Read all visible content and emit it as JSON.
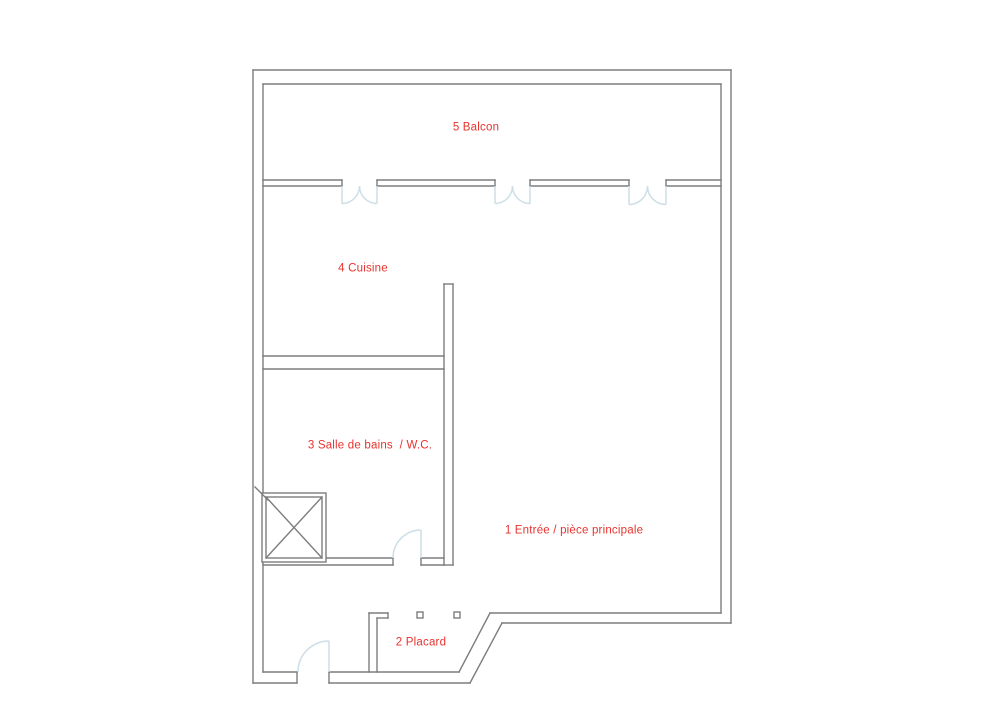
{
  "document": {
    "type": "apartment floor plan"
  },
  "colors": {
    "background": "#ffffff",
    "wall": "#7d7d7d",
    "door": "#ccdfe7",
    "label": "#e8322d"
  },
  "rooms": [
    {
      "number": "1",
      "label": "1 Entrée / pièce principale"
    },
    {
      "number": "2",
      "label": "2 Placard"
    },
    {
      "number": "3",
      "label": "3 Salle de bains  / W.C."
    },
    {
      "number": "4",
      "label": "4 Cuisine"
    },
    {
      "number": "5",
      "label": "5 Balcon"
    }
  ]
}
